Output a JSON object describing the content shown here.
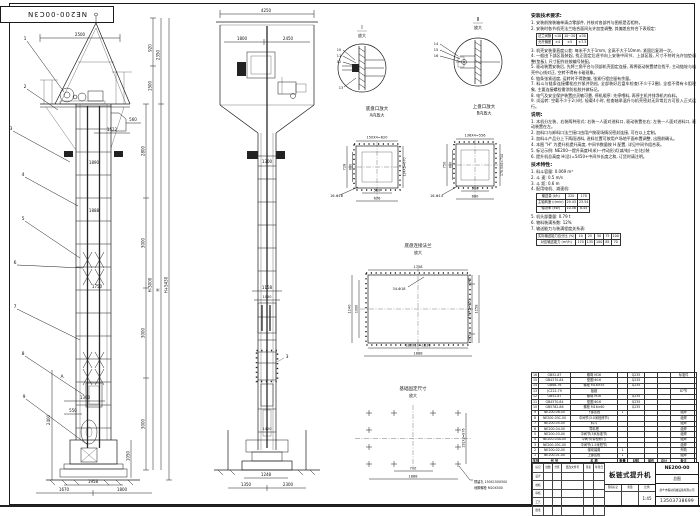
{
  "stamp": {
    "text": "NE200-00C3N"
  },
  "front_view": {
    "dims": {
      "d2500": "2500",
      "d2350": "2350",
      "d920": "920",
      "d1500": "1500",
      "d2800": "2800",
      "d3000a": "3000",
      "d3000b": "3000",
      "d3000c": "3000",
      "dHm": "H-3000",
      "dH": "H",
      "dHp": "H+5430",
      "d560": "560",
      "d1522": "1522",
      "d1890": "1890",
      "d1888": "1888",
      "d1750": "1750",
      "d1300": "1300",
      "d550": "550",
      "d2400": "2400",
      "d1050": "1050",
      "d1958": "1958",
      "d1670": "1670",
      "d1800": "1800"
    },
    "leaders": [
      "1",
      "2",
      "3",
      "4",
      "5",
      "6",
      "7",
      "8",
      "9"
    ],
    "section_mark": "A"
  },
  "side_view": {
    "dims": {
      "d4250": "4250",
      "d1800": "1800",
      "d2450": "2450",
      "d1300": "1300",
      "d1158": "1158",
      "d1050": "1050",
      "d1420": "1420",
      "d1248": "1248",
      "d1350": "1350",
      "d2300": "2300"
    },
    "leader": "3"
  },
  "detail_I": {
    "title": "I",
    "subtitle": "放大",
    "leaders": [
      "10",
      "11",
      "12",
      "13"
    ],
    "caption1": "底盘口放大",
    "caption2": "A向放大"
  },
  "detail_II": {
    "title": "II",
    "subtitle": "放大",
    "leaders": [
      "14",
      "15",
      "16"
    ],
    "caption1": "上盘口放大",
    "caption2": "B向放大"
  },
  "section_A": {
    "top": "150X4=620",
    "left_outer": "728",
    "left_inner": "600",
    "right": "134X5=670",
    "bot_inner": "500",
    "bot_outer": "676",
    "holes": "16-Φ18"
  },
  "section_B": {
    "top": "136X4=556",
    "left_outer": "750",
    "left_inner": "600",
    "right": "178.5X4=714",
    "bot_inner": "500",
    "bot_outer": "600",
    "holes": "16-Φ14"
  },
  "flange": {
    "title1": "底盘连接法兰",
    "title2": "放大",
    "top": "1758",
    "holes": "34-Φ18",
    "left_outer": "1140",
    "left_inner": "1000",
    "right_top": "145",
    "right_mid": "170X5=850",
    "right_bot": "145",
    "right_outer": "1158",
    "bot_inner": "183X10=1830",
    "bot_outer": "1888"
  },
  "foundation": {
    "title1": "基础固定尺寸",
    "title2": "放大",
    "d700": "700",
    "d1888": "1888",
    "right": "292X3=876",
    "note1": "预留孔 150X150X500",
    "note2": "地脚螺栓 M20X500"
  },
  "install_notes": {
    "heading": "安装技术要求:",
    "items_a": [
      "1. 安装前按装箱单清点零部件, 并核对各部件与图纸是否相符。",
      "2. 安装时各节机壳法兰结合面间允许加垫调整, 其偏差应符合下表规定:"
    ],
    "table_rows": [
      [
        "法兰间隙",
        "<10",
        "10~20",
        "≥30"
      ],
      [
        "允许偏差",
        "±4",
        "±5",
        "±7.5"
      ]
    ],
    "items_b": [
      "3. 机壳安装垂直度公差: 每米不大于1mm, 全高不大于10mm, 紧固后复测一次。",
      "4. 一般由下部区段装起, 找正固定后逐节向上安装中间节、上部区段, 尺寸不符时允许加垫调整(垫板), 尺寸配作处按编号装配。",
      "5. 驱动装置安装后, 先将三角平台与顶部机壳固定连接, 再将驱动装置就位找平, 主动链轮与机壳中心线对正, 空转不得有卡碰现象。",
      "6. 链条张紧适度, 运转时不得跑偏, 张紧行程应留有余量。",
      "7. 料斗与链条连接螺栓应拧紧并防松, 全部装好后盘车检查(不少于2圈), 全程不得有卡阻现象, 主要连接螺栓需涂防松胶并做标记。",
      "8. 电气及安全保护装置应灵敏可靠, 停机顺序: 先停喂料, 再停主机并排净机内存料。",
      "9. 试运转: 空载不少于2小时, 轻载4小时, 检查轴承温升与机壳密封无异常后方可投入正式运行。"
    ]
  },
  "remarks": {
    "heading": "说明:",
    "items": [
      "1. 本机分左装、右装两种形式: 右装—人面对进料口, 驱动装置在右; 左装—人面对进料口, 驱动装置在左。",
      "2. 加料口与卸料口法兰接口由用户按现场情况密封连接, 可在以上定制。",
      "3. 加料斗产品分上下两段进料, 进料位置可按用户场地平面布置调整, 出图前确认。",
      "4. 本图 \"H\" 为提升机提升高度, 中间节数量按 H 配置, 详见中间节组合表。",
      "5. 标记示例: NE200—提升高度H(米)—传动形式(减/电)—左(右)装",
      "6. 提升机总高度 H(总)=5450+中间节长度之和, 订货时请注明。"
    ]
  },
  "specs": {
    "heading": "技术特性:",
    "items_a": [
      "1. 料斗容量:  0.069 m³",
      "2. 斗    速:  0.5 m/s",
      "3. 斗    距:  0.6 m",
      "4. 配用电机、减速机:"
    ],
    "motor_rows": [
      [
        "输送量 (t/h)",
        "220",
        "170"
      ],
      [
        "主轴转速 (r/min)",
        "29.43",
        "23.54"
      ],
      [
        "轴功率 (kW)",
        "10.56",
        "8.45"
      ]
    ],
    "items_b": [
      "5. 机头部重量: 0.79 t",
      "6. 物料装满系数: 12%",
      "7. 输送能力与装满程度关系表:"
    ],
    "capacity_rows": [
      [
        "实际输送能力百分比 (%)",
        "10",
        "25",
        "50",
        "75",
        "100"
      ],
      [
        "对应输送能力 (m³/h)",
        "170",
        "135",
        "100",
        "85",
        "70"
      ]
    ]
  },
  "bom": {
    "rows": [
      [
        "16",
        "GB52-87",
        "螺母 M16",
        "",
        "Q235",
        "",
        "",
        "标准件"
      ],
      [
        "15",
        "GB4370-84",
        "垫圈 Φ16",
        "",
        "Q235",
        "",
        "",
        ""
      ],
      [
        "14",
        "GB68-76",
        "螺栓 M16×55",
        "",
        "Q235",
        "",
        "",
        ""
      ],
      [
        "13",
        "JC222-79",
        "板链",
        "",
        "",
        "",
        "",
        "87节"
      ],
      [
        "12",
        "GB52-87",
        "螺母 M16",
        "",
        "Q235",
        "",
        "",
        ""
      ],
      [
        "11",
        "GB4370-84",
        "垫圈 Φ16",
        "",
        "Q235",
        "",
        "",
        ""
      ],
      [
        "10",
        "GB5782-86",
        "螺栓 M16×60",
        "",
        "Q235",
        "",
        "",
        ""
      ],
      [
        "9",
        "NE200-06-00",
        "下部区段",
        "1",
        "",
        "",
        "",
        "组焊"
      ],
      [
        "8",
        "NE200-03C-00",
        "中间节(3.0米检修节)",
        "",
        "",
        "",
        "",
        "组焊"
      ],
      [
        "7",
        "NE200-05-00",
        "料斗",
        "",
        "",
        "",
        "",
        "组焊"
      ],
      [
        "6",
        "NE200-04-00",
        "导料槽",
        "",
        "",
        "",
        "",
        "组焊"
      ],
      [
        "5",
        "NE200-03-00",
        "中间节(3米标准节)",
        "",
        "",
        "",
        "",
        "组焊"
      ],
      [
        "4",
        "NE200-03A-00",
        "中间节(带检修门)",
        "",
        "",
        "",
        "",
        "组焊"
      ],
      [
        "3",
        "NE200-03C-00",
        "中间节(1.5米短节)",
        "",
        "",
        "",
        "",
        "组焊"
      ],
      [
        "2",
        "NE200-02-00",
        "驱动装置",
        "1",
        "",
        "",
        "",
        "外购"
      ],
      [
        "1",
        "NE200-01-00",
        "上部区段",
        "1",
        "",
        "",
        "",
        "组焊"
      ],
      [
        "序号",
        "代  号",
        "名    称",
        "数量",
        "材料",
        "单件",
        "总计",
        "备注"
      ]
    ]
  },
  "title_block": {
    "title": "板链式提升机",
    "drawing_no": "NE200-00",
    "doc_type": "总图",
    "company": "新乡市振动机械设备有限公司",
    "phone": "13503738699",
    "scale_value": "1:45",
    "strip_labels": [
      "阶段标记",
      "重量",
      "比例"
    ],
    "grid_rows": [
      [
        "标记",
        "处数",
        "分区",
        "更改文件号",
        "签名",
        "年月日"
      ],
      [
        "设计",
        "",
        "",
        "",
        "",
        ""
      ],
      [
        "校核",
        "",
        "",
        "",
        "",
        ""
      ],
      [
        "审核",
        "",
        "",
        "",
        "",
        ""
      ],
      [
        "工艺",
        "",
        "",
        "",
        "",
        ""
      ],
      [
        "批准",
        "",
        "",
        "",
        "",
        ""
      ]
    ]
  }
}
